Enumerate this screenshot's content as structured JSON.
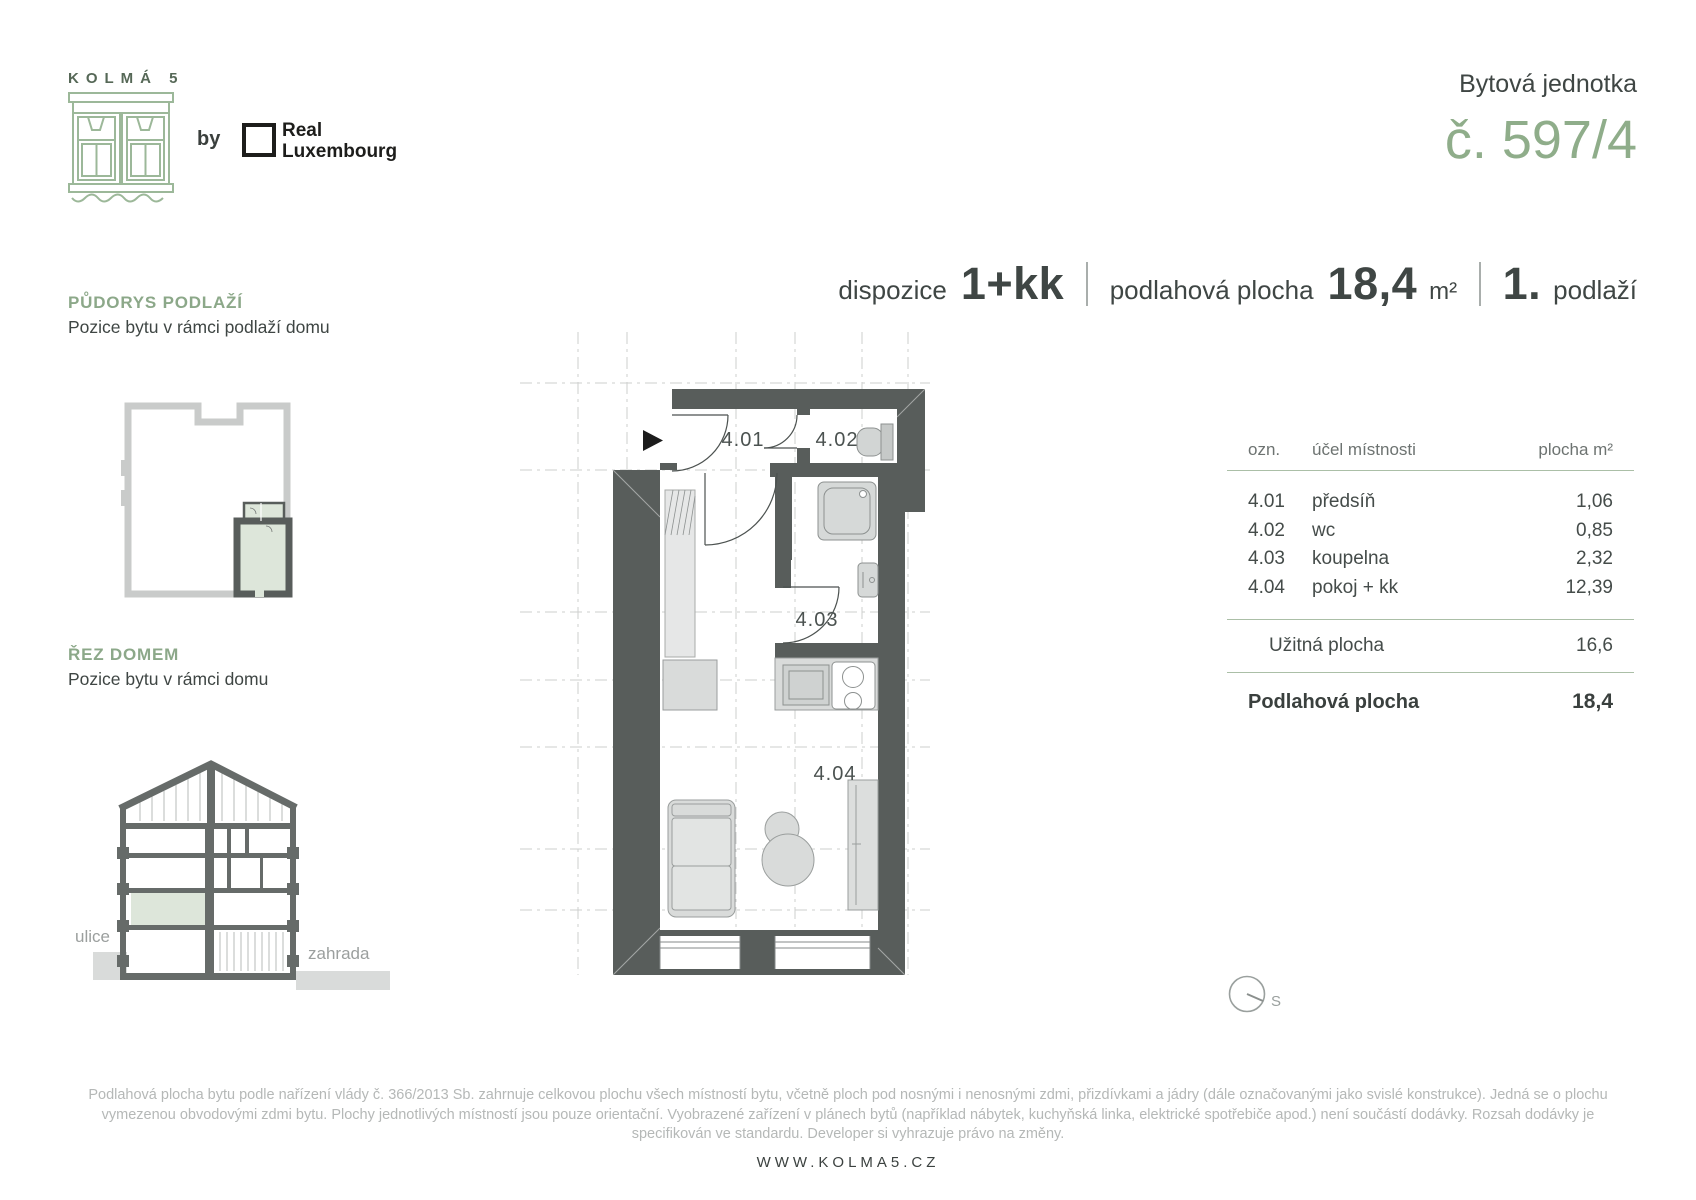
{
  "brand": {
    "logo_title": "KOLMÁ 5",
    "by_label": "by",
    "partner_line1": "Real",
    "partner_line2": "Luxembourg"
  },
  "unit_header": {
    "label": "Bytová jednotka",
    "number": "č. 597/4"
  },
  "specs": {
    "layout_label": "dispozice",
    "layout_value": "1+kk",
    "area_label": "podlahová plocha",
    "area_value": "18,4",
    "area_unit": "m²",
    "floor_value": "1.",
    "floor_label": "podlaží"
  },
  "sections": {
    "floor_position": {
      "title": "PŮDORYS PODLAŽÍ",
      "subtitle": "Pozice bytu v rámci podlaží domu"
    },
    "house_section": {
      "title": "ŘEZ DOMEM",
      "subtitle": "Pozice bytu v rámci domu",
      "street_label": "ulice",
      "garden_label": "zahrada"
    }
  },
  "plan": {
    "rooms": {
      "r401": "4.01",
      "r402": "4.02",
      "r403": "4.03",
      "r404": "4.04"
    },
    "compass_label": "S"
  },
  "room_table": {
    "headers": {
      "id": "ozn.",
      "purpose": "účel místnosti",
      "area": "plocha m²"
    },
    "rows": [
      {
        "id": "4.01",
        "purpose": "předsíň",
        "area": "1,06"
      },
      {
        "id": "4.02",
        "purpose": "wc",
        "area": "0,85"
      },
      {
        "id": "4.03",
        "purpose": "koupelna",
        "area": "2,32"
      },
      {
        "id": "4.04",
        "purpose": "pokoj + kk",
        "area": "12,39"
      }
    ],
    "usable": {
      "label": "Užitná plocha",
      "value": "16,6"
    },
    "total": {
      "label": "Podlahová plocha",
      "value": "18,4"
    }
  },
  "footer": {
    "disclaimer": "Podlahová plocha bytu podle nařízení vlády č. 366/2013 Sb. zahrnuje celkovou plochu všech místností bytu, včetně ploch pod nosnými i nenosnými zdmi, přizdívkami a jádry (dále označovanými jako svislé konstrukce). Jedná se o plochu vymezenou obvodovými zdmi bytu. Plochy jednotlivých místností jsou pouze orientační. Vyobrazené zařízení v plánech bytů (například nábytek, kuchyňská linka, elektrické spotřebiče apod.) není součástí dodávky. Rozsah dodávky je specifikován ve standardu. Developer si vyhrazuje právo na změny.",
    "website": "WWW.KOLMA5.CZ"
  },
  "colors": {
    "accent_green": "#8FAD8A",
    "heading_green": "#8CA889",
    "pale_green_fill": "#DDE6DA",
    "wall_gray": "#585D5B",
    "outline_light_gray": "#C9CBCA",
    "text_dark": "#3F4644",
    "text_muted": "#9B9F9E",
    "divider_green": "#ABBFA7"
  }
}
